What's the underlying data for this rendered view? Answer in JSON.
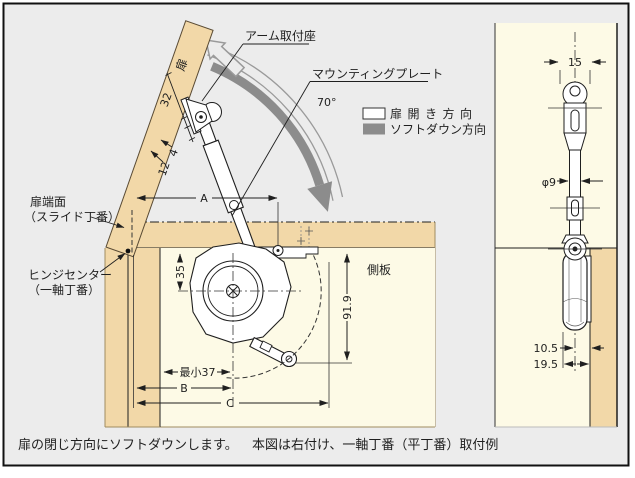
{
  "captions": {
    "left": "扉の閉じ方向にソフトダウンします。",
    "right": "本図は右付け、一軸丁番（平丁番）取付例"
  },
  "legend": {
    "open_label": "扉開き方向",
    "soft_label": "ソフトダウン方向"
  },
  "labels": {
    "door": "扉",
    "arm_seat": "アーム取付座",
    "mounting_plate": "マウンティングプレート",
    "angle": "70°",
    "door_edge_1": "扉端面",
    "door_edge_2": "（スライド丁番）",
    "hinge_center_1": "ヒンジセンター",
    "hinge_center_2": "（一軸丁番）",
    "side_panel": "側板"
  },
  "dims_main": {
    "d32": "32",
    "d4": "4",
    "d12": "12",
    "a": "A",
    "d35": "35",
    "d91_9": "91.9",
    "min37": "最小37",
    "b": "B",
    "c": "C"
  },
  "dims_side": {
    "d15": "15",
    "dia9": "φ9",
    "d10_5": "10.5",
    "d19_5": "19.5"
  },
  "colors": {
    "background": "#ececec",
    "wood": "#f2d8a8",
    "interior": "#fdfae6",
    "arrow_gray": "#8c8c8c",
    "line": "#1f1f1f"
  }
}
